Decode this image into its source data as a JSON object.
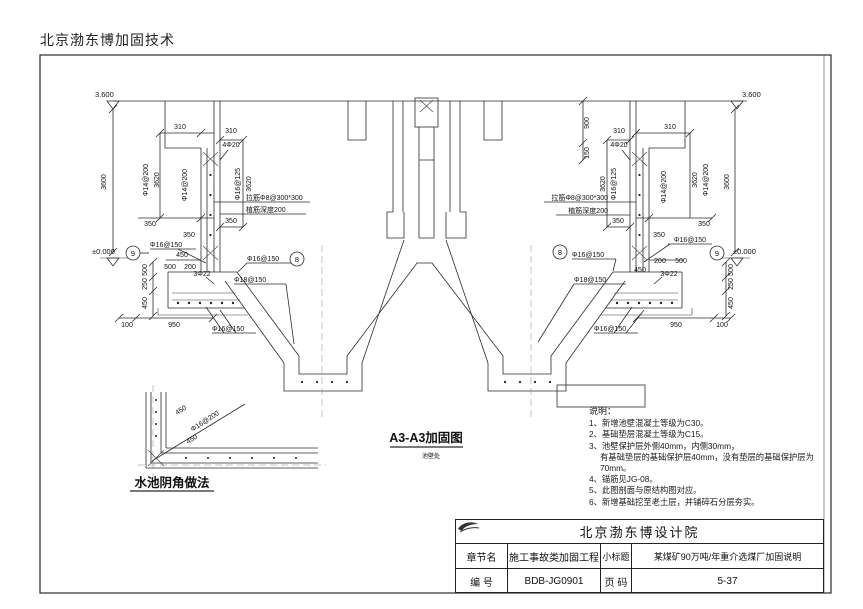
{
  "header": {
    "company": "北京渤东博加固技术"
  },
  "drawing": {
    "title": "A3-A3加固图",
    "subtitle": "池壁处",
    "elev_top": "3.600",
    "elev_zero": "±0.000"
  },
  "dims": {
    "d3600": "3600",
    "d3620": "3620",
    "d310": "310",
    "d350": "350",
    "d450": "450",
    "d500": "500",
    "d250": "250",
    "d200": "200",
    "d100": "100",
    "d950": "950",
    "d900": "900",
    "d150": "150"
  },
  "rebar": {
    "r14": "Φ14@200",
    "r16a": "Φ16@125",
    "r16b": "Φ16@150",
    "r18": "Φ18@150",
    "r4_20": "4Φ20",
    "r3_22": "3Φ22",
    "tie": "拉筋Φ8@300*300",
    "anchor": "植筋深度200"
  },
  "bubbles": {
    "b8": "8",
    "b9": "9"
  },
  "detail": {
    "title": "水池阴角做法",
    "bar": "Φ16@200",
    "d450": "450"
  },
  "notes": {
    "heading": "说明：",
    "items": [
      "1、新增池壁混凝土等级为C30。",
      "2、基础垫层混凝土等级为C15。",
      "3、池壁保护层外侧40mm，内侧30mm，",
      "有基础垫层的基础保护层40mm，没有垫层的基础保护层为70mm。",
      "4、锚筋见JG-08。",
      "5、此图剖面与原结构图对应。",
      "6、新增基础挖至老土层，并铺碎石分层夯实。"
    ]
  },
  "title_block": {
    "institute": "北京渤东博设计院",
    "chapter_label": "章节名",
    "chapter_value": "施工事故类加固工程",
    "subtitle_label": "小标题",
    "subtitle_value": "某煤矿90万吨/年重介选煤厂加固说明",
    "number_label": "编  号",
    "number_value": "BDB-JG0901",
    "page_label": "页  码",
    "page_value": "5-37"
  }
}
